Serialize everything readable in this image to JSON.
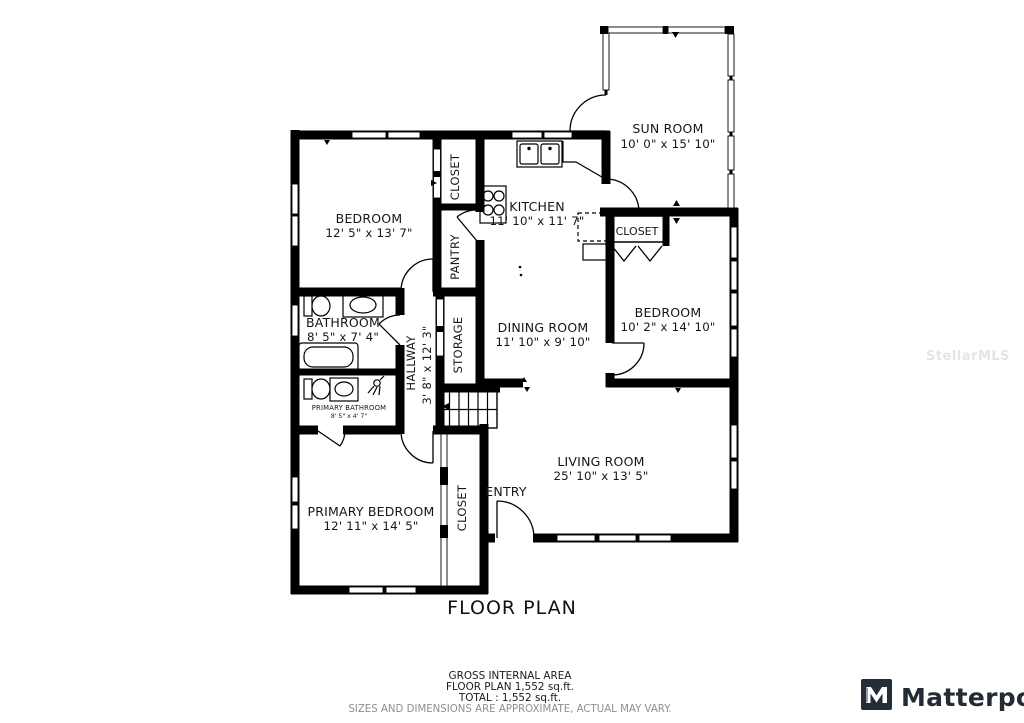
{
  "title": "FLOOR PLAN",
  "watermark": "StellarMLS",
  "rooms": {
    "sun_room": {
      "name": "SUN ROOM",
      "dims": "10' 0\" x 15' 10\""
    },
    "kitchen": {
      "name": "KITCHEN",
      "dims": "11' 10\" x 11' 7\""
    },
    "bedroom_top": {
      "name": "BEDROOM",
      "dims": "12' 5\" x 13' 7\""
    },
    "closet_top": {
      "name": "CLOSET"
    },
    "pantry": {
      "name": "PANTRY"
    },
    "bathroom": {
      "name": "BATHROOM",
      "dims": "8' 5\" x 7' 4\""
    },
    "primary_bathroom": {
      "name": "PRIMARY BATHROOM",
      "dims": "8' 5\" x 4' 7\""
    },
    "hallway": {
      "name": "HALLWAY",
      "dims": "3' 8\" x 12' 3\""
    },
    "storage": {
      "name": "STORAGE"
    },
    "closet_bedroom": {
      "name": "CLOSET"
    },
    "bedroom_right": {
      "name": "BEDROOM",
      "dims": "10' 2\" x 14' 10\""
    },
    "dining_room": {
      "name": "DINING ROOM",
      "dims": "11' 10\" x 9' 10\""
    },
    "living_room": {
      "name": "LIVING ROOM",
      "dims": "25' 10\" x 13' 5\""
    },
    "entry": {
      "name": "ENTRY"
    },
    "closet_primary": {
      "name": "CLOSET"
    },
    "primary_bedroom": {
      "name": "PRIMARY BEDROOM",
      "dims": "12' 11\" x 14' 5\""
    }
  },
  "footer": {
    "line1": "GROSS INTERNAL AREA",
    "line2": "FLOOR PLAN 1,552 sq.ft.",
    "line3": "TOTAL :  1,552 sq.ft.",
    "disclaimer": "SIZES AND DIMENSIONS ARE APPROXIMATE, ACTUAL MAY VARY."
  },
  "branding": {
    "logo_text": "Matterport"
  },
  "colors": {
    "wall": "#000000",
    "logo": "#222b36",
    "disclaimer_gray": "#8f8f8f",
    "watermark_gray": "#e4e4e4"
  }
}
